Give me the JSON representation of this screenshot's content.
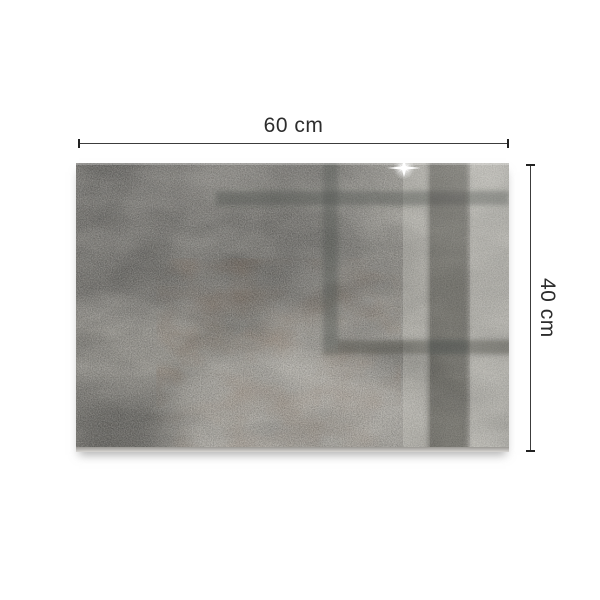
{
  "canvas": {
    "background": "#ffffff"
  },
  "annotation": {
    "width_label": "60 cm",
    "height_label": "40 cm",
    "line_color": "#3c3c3c",
    "text_color": "#2d2d2d",
    "style": "dimension lines with perpendicular end ticks"
  },
  "panel": {
    "description": "grey concrete-texture glass panel with dark window-frame reflections on the right and a white sparkle glare near the top edge",
    "base_color": "#908e8a",
    "light_color": "#aaa8a3",
    "dark_reflection_color": "#5f615d",
    "brown_tint": "#8d7a6c",
    "edge_highlight": "#d8d6d3",
    "sparkle_color": "#ffffff"
  }
}
